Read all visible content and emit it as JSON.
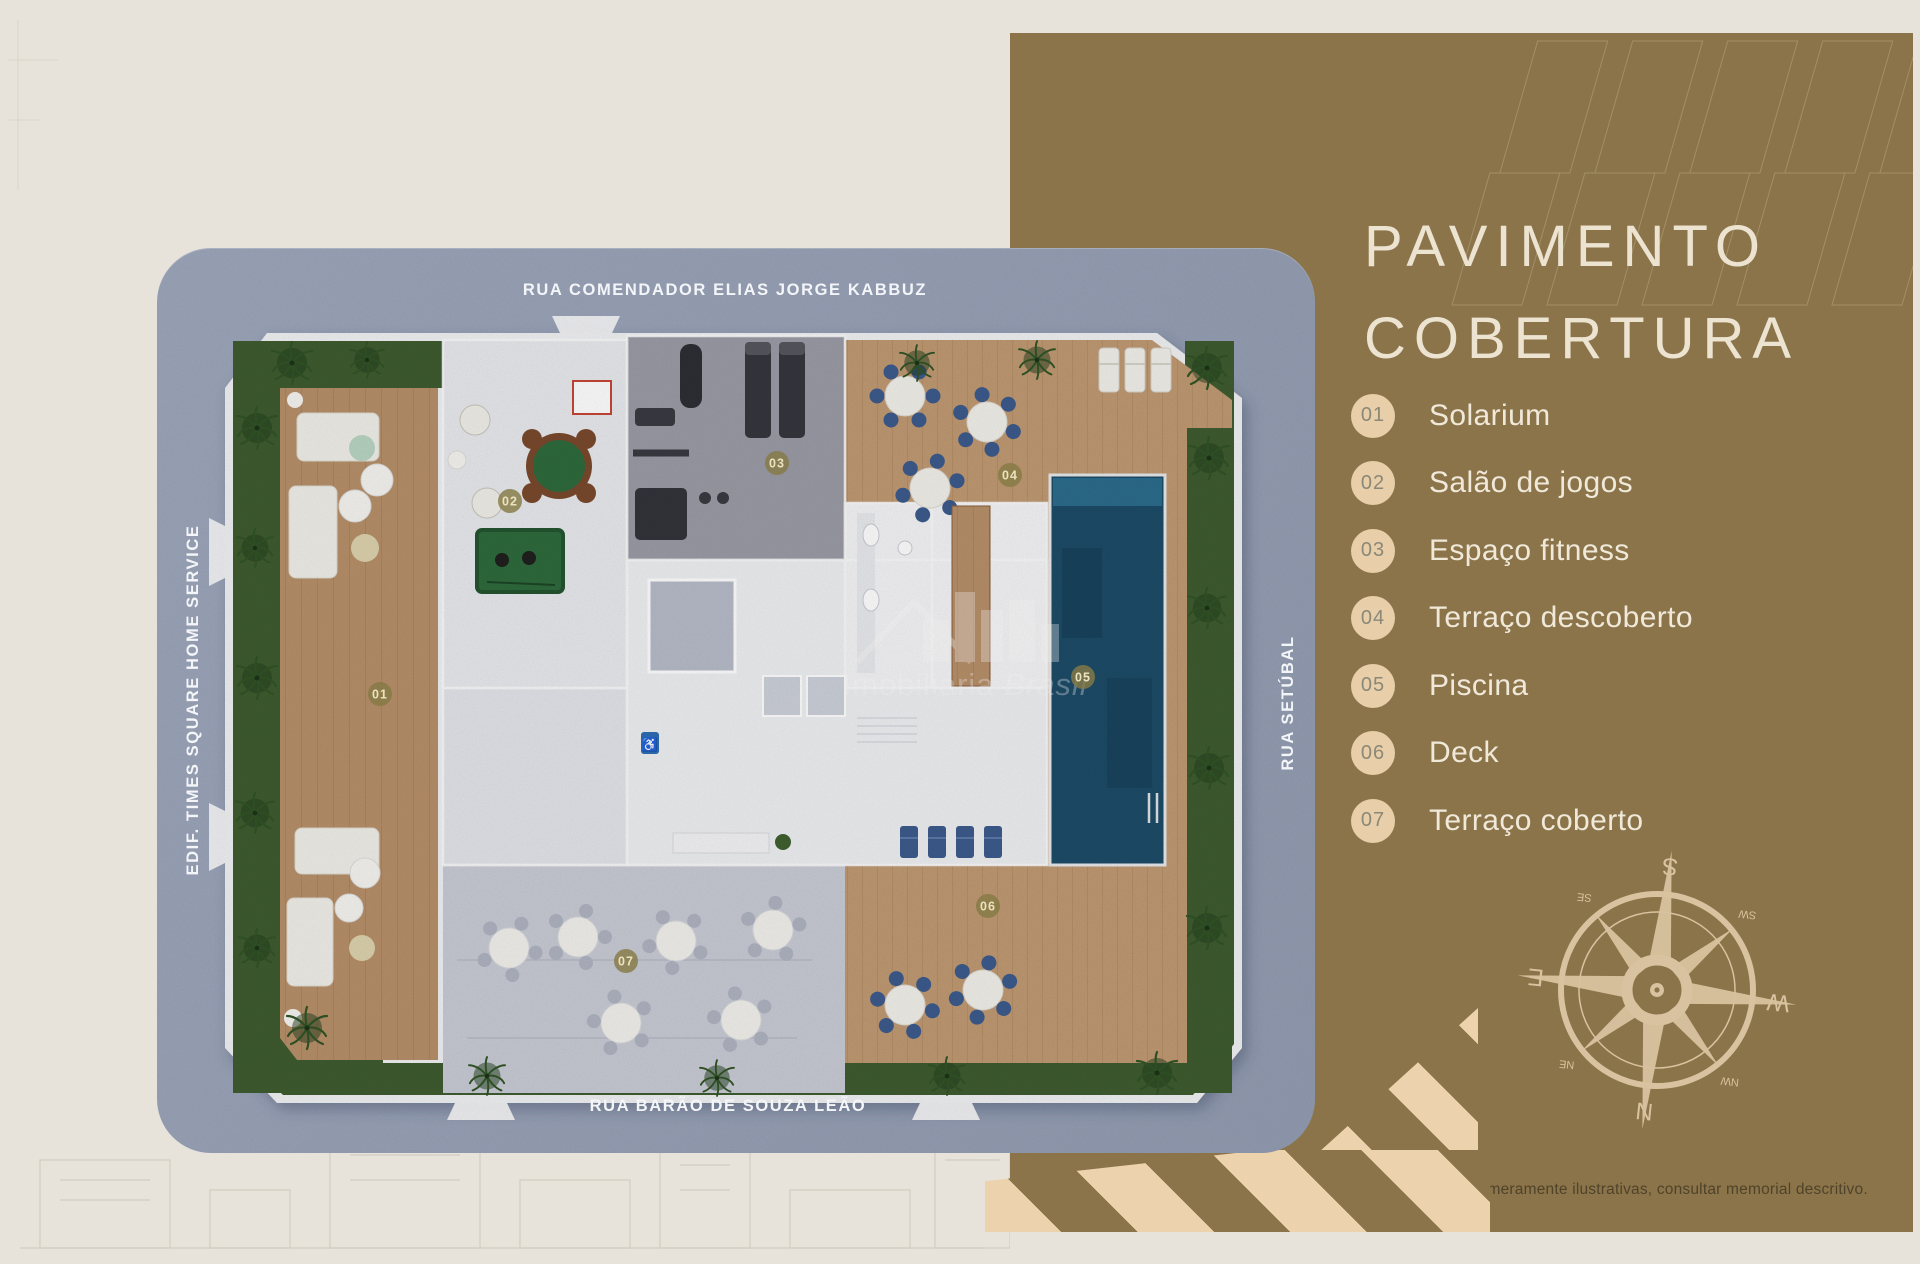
{
  "panel": {
    "title_line1": "PAVIMENTO",
    "title_line2": "COBERTURA",
    "legend": [
      {
        "num": "01",
        "label": "Solarium"
      },
      {
        "num": "02",
        "label": "Salão de jogos"
      },
      {
        "num": "03",
        "label": "Espaço fitness"
      },
      {
        "num": "04",
        "label": "Terraço descoberto"
      },
      {
        "num": "05",
        "label": "Piscina"
      },
      {
        "num": "06",
        "label": "Deck"
      },
      {
        "num": "07",
        "label": "Terraço coberto"
      }
    ],
    "disclaimer": "Imagens meramente ilustrativas, consultar memorial descritivo."
  },
  "plan": {
    "streets": {
      "top": "RUA COMENDADOR ELIAS JORGE KABBUZ",
      "bottom": "RUA BARÃO DE SOUZA LEÃO",
      "left": "EDIF. TIMES SQUARE HOME SERVICE",
      "right": "RUA SETÚBAL"
    },
    "watermark": {
      "brand": "Imobiliária",
      "suffix": "Brasil"
    }
  },
  "compass": {
    "n": "N",
    "s": "S",
    "e": "E",
    "w": "W",
    "ne": "NE",
    "nw": "NW",
    "se": "SE",
    "sw": "SW"
  },
  "colors": {
    "gold_panel": "#8b744a",
    "card_street": "#9aa3b8",
    "badge": "#e8cea9",
    "title": "#ece3d0",
    "pool": "#1d4c68",
    "stripe_tan": "#edd2ae"
  }
}
